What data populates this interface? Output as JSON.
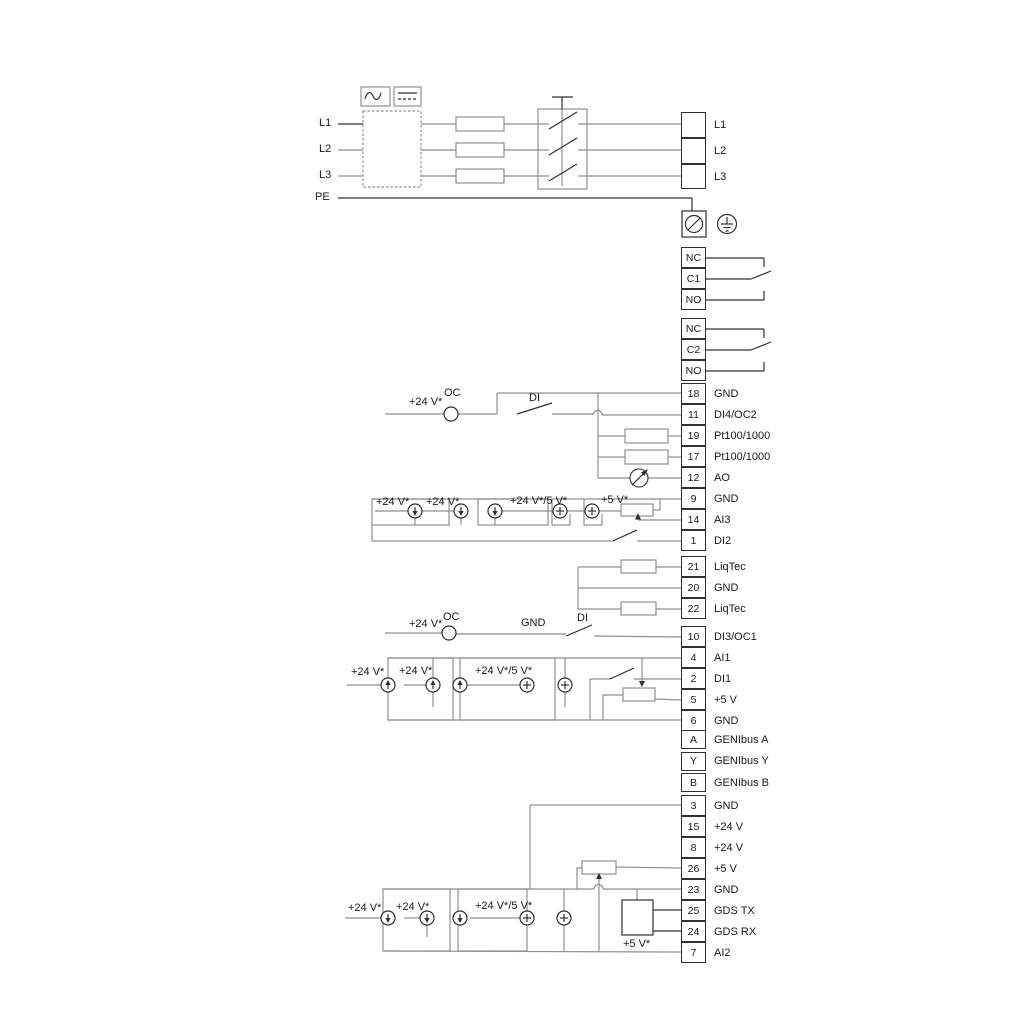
{
  "colors": {
    "wire": "#8f8f8f",
    "dark": "#303030",
    "text": "#1a1a1a",
    "background": "#ffffff"
  },
  "input": {
    "l1": "L1",
    "l2": "L2",
    "l3": "L3",
    "pe": "PE"
  },
  "output": [
    "L1",
    "L2",
    "L3"
  ],
  "relay1": [
    "NC",
    "C1",
    "NO"
  ],
  "relay2": [
    "NC",
    "C2",
    "NO"
  ],
  "groups": {
    "io1": [
      {
        "n": "18",
        "label": "GND"
      },
      {
        "n": "11",
        "label": "DI4/OC2"
      },
      {
        "n": "19",
        "label": "Pt100/1000"
      },
      {
        "n": "17",
        "label": "Pt100/1000"
      },
      {
        "n": "12",
        "label": "AO"
      },
      {
        "n": "9",
        "label": "GND"
      },
      {
        "n": "14",
        "label": "AI3"
      },
      {
        "n": "1",
        "label": "DI2"
      }
    ],
    "liqtec": [
      {
        "n": "21",
        "label": "LiqTec"
      },
      {
        "n": "20",
        "label": "GND"
      },
      {
        "n": "22",
        "label": "LiqTec"
      }
    ],
    "io2": [
      {
        "n": "10",
        "label": "DI3/OC1"
      },
      {
        "n": "4",
        "label": "AI1"
      },
      {
        "n": "2",
        "label": "DI1"
      },
      {
        "n": "5",
        "label": "+5 V"
      },
      {
        "n": "6",
        "label": "GND"
      }
    ],
    "genibus": [
      {
        "n": "A",
        "label": "GENIbus A"
      },
      {
        "n": "Y",
        "label": "GENIbus Y"
      },
      {
        "n": "B",
        "label": "GENIbus B"
      }
    ],
    "io3": [
      {
        "n": "3",
        "label": "GND"
      },
      {
        "n": "15",
        "label": "+24 V"
      },
      {
        "n": "8",
        "label": "+24 V"
      },
      {
        "n": "26",
        "label": "+5 V"
      },
      {
        "n": "23",
        "label": "GND"
      },
      {
        "n": "25",
        "label": "GDS TX"
      },
      {
        "n": "24",
        "label": "GDS RX"
      },
      {
        "n": "7",
        "label": "AI2"
      }
    ]
  },
  "annotations": [
    "+24 V*",
    "OC",
    "DI",
    "+24 V*",
    "+24 V*",
    "+24 V*/5 V*",
    "+5 V*",
    "+24 V*",
    "OC",
    "GND",
    "DI",
    "+24 V*",
    "+24 V*",
    "+24 V*/5 V*",
    "+24 V*",
    "+24 V*",
    "+24 V*/5 V*",
    "+5 V*"
  ],
  "icons": {
    "ac_symbol": "ac-sine-icon",
    "dc_symbol": "dc-line-icon",
    "screw_terminal": "screw-terminal-icon",
    "protective_earth": "earth-ground-icon",
    "analog_output": "meter-arrow-icon",
    "supply_source": "current-source-icon"
  }
}
